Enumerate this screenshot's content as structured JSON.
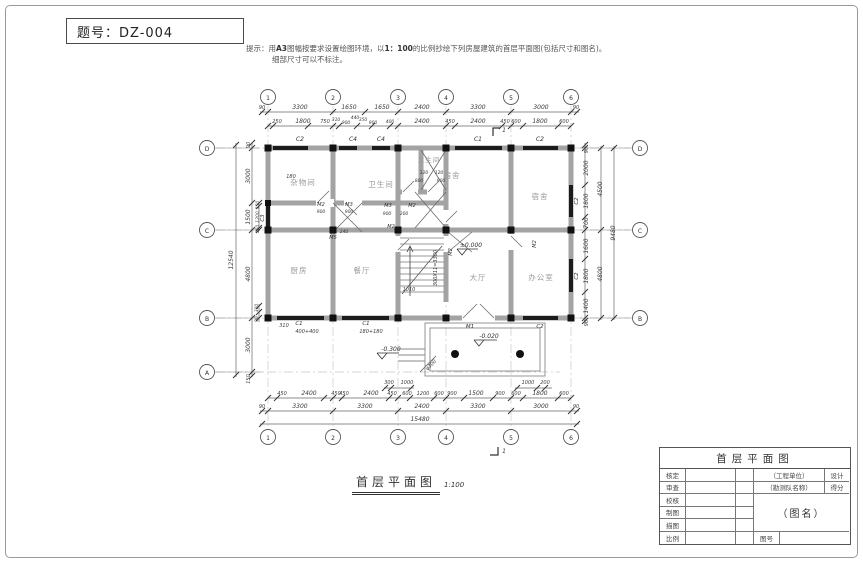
{
  "header": {
    "exam_label": "题号：DZ-004"
  },
  "hint": {
    "prefix": "提示：用",
    "bold1": "A3",
    "mid1": "图幅按要求设置绘图环境，以",
    "bold2": "1：100",
    "rest": "的比例抄绘下列房屋建筑的首层平面图(包括尺寸和图名)。",
    "line2": "细部尺寸可以不标注。"
  },
  "caption": {
    "title": "首层平面图",
    "scale": "1:100"
  },
  "title_block": {
    "header": "首层平面图",
    "row_labels": [
      "核定",
      "审查",
      "校核",
      "制图",
      "描图",
      "比例"
    ],
    "org": "（工程单位）",
    "design": "设计",
    "team": "（勘测队名称）",
    "score": "得分",
    "name": "（图名）",
    "no_label": "图号"
  },
  "plan": {
    "scale_note": "1:100",
    "rooms": [
      "杂物间",
      "卫生间",
      "卫生间",
      "宿舍",
      "宿舍",
      "厨房",
      "餐厅",
      "大厅",
      "办公室"
    ],
    "labels": [
      {
        "t": "1",
        "x": 268,
        "y": 100,
        "c": "axis"
      },
      {
        "t": "2",
        "x": 333,
        "y": 100,
        "c": "axis"
      },
      {
        "t": "3",
        "x": 398,
        "y": 100,
        "c": "axis"
      },
      {
        "t": "4",
        "x": 446,
        "y": 100,
        "c": "axis"
      },
      {
        "t": "5",
        "x": 511,
        "y": 100,
        "c": "axis"
      },
      {
        "t": "6",
        "x": 571,
        "y": 100,
        "c": "axis"
      },
      {
        "t": "1",
        "x": 268,
        "y": 440,
        "c": "axis"
      },
      {
        "t": "2",
        "x": 333,
        "y": 440,
        "c": "axis"
      },
      {
        "t": "3",
        "x": 398,
        "y": 440,
        "c": "axis"
      },
      {
        "t": "4",
        "x": 446,
        "y": 440,
        "c": "axis"
      },
      {
        "t": "5",
        "x": 511,
        "y": 440,
        "c": "axis"
      },
      {
        "t": "6",
        "x": 571,
        "y": 440,
        "c": "axis"
      },
      {
        "t": "D",
        "x": 207,
        "y": 151,
        "c": "axis"
      },
      {
        "t": "C",
        "x": 207,
        "y": 233,
        "c": "axis"
      },
      {
        "t": "B",
        "x": 207,
        "y": 321,
        "c": "axis"
      },
      {
        "t": "A",
        "x": 207,
        "y": 375,
        "c": "axis"
      },
      {
        "t": "D",
        "x": 640,
        "y": 151,
        "c": "axis"
      },
      {
        "t": "C",
        "x": 640,
        "y": 233,
        "c": "axis"
      },
      {
        "t": "B",
        "x": 640,
        "y": 321,
        "c": "axis"
      },
      {
        "t": "杂物间",
        "x": 303,
        "y": 185,
        "c": "room",
        "s": 7.5
      },
      {
        "t": "卫生间",
        "x": 381,
        "y": 187,
        "c": "room",
        "s": 7.5
      },
      {
        "t": "卫生间",
        "x": 429,
        "y": 162,
        "c": "room",
        "s": 6.5
      },
      {
        "t": "宿舍",
        "x": 452,
        "y": 178,
        "c": "room",
        "s": 7.5
      },
      {
        "t": "宿舍",
        "x": 540,
        "y": 199,
        "c": "room",
        "s": 7.5
      },
      {
        "t": "厨房",
        "x": 299,
        "y": 273,
        "c": "room",
        "s": 7.5
      },
      {
        "t": "餐厅",
        "x": 362,
        "y": 273,
        "c": "room",
        "s": 7.5
      },
      {
        "t": "大厅",
        "x": 478,
        "y": 280,
        "c": "room",
        "s": 7.5
      },
      {
        "t": "办公室",
        "x": 541,
        "y": 280,
        "c": "room",
        "s": 7.5
      },
      {
        "t": "90",
        "x": 262,
        "y": 109,
        "s": 5
      },
      {
        "t": "3300",
        "x": 300,
        "y": 109,
        "s": 6
      },
      {
        "t": "1650",
        "x": 349,
        "y": 109,
        "s": 6
      },
      {
        "t": "1650",
        "x": 382,
        "y": 109,
        "s": 6
      },
      {
        "t": "2400",
        "x": 422,
        "y": 109,
        "s": 6
      },
      {
        "t": "3300",
        "x": 478,
        "y": 109,
        "s": 6
      },
      {
        "t": "3000",
        "x": 541,
        "y": 109,
        "s": 6
      },
      {
        "t": "90",
        "x": 576,
        "y": 109,
        "s": 5
      },
      {
        "t": "250",
        "x": 277,
        "y": 123,
        "s": 5
      },
      {
        "t": "1800",
        "x": 303,
        "y": 123,
        "s": 6
      },
      {
        "t": "750",
        "x": 325,
        "y": 123,
        "s": 5
      },
      {
        "t": "310",
        "x": 336,
        "y": 121,
        "s": 4.5
      },
      {
        "t": "900",
        "x": 346,
        "y": 124,
        "s": 4.5
      },
      {
        "t": "440",
        "x": 355,
        "y": 119,
        "s": 4.5
      },
      {
        "t": "350",
        "x": 363,
        "y": 121,
        "s": 4.5
      },
      {
        "t": "900",
        "x": 373,
        "y": 124,
        "s": 4.5
      },
      {
        "t": "400",
        "x": 390,
        "y": 123,
        "s": 4.5
      },
      {
        "t": "2400",
        "x": 422,
        "y": 123,
        "s": 6
      },
      {
        "t": "450",
        "x": 450,
        "y": 123,
        "s": 5
      },
      {
        "t": "2400",
        "x": 478,
        "y": 123,
        "s": 6
      },
      {
        "t": "450",
        "x": 505,
        "y": 123,
        "s": 5
      },
      {
        "t": "600",
        "x": 516,
        "y": 123,
        "s": 5
      },
      {
        "t": "1800",
        "x": 540,
        "y": 123,
        "s": 6
      },
      {
        "t": "600",
        "x": 564,
        "y": 123,
        "s": 5
      },
      {
        "t": "C2",
        "x": 300,
        "y": 141,
        "c": "win",
        "s": 6
      },
      {
        "t": "C4",
        "x": 353,
        "y": 141,
        "c": "win",
        "s": 6
      },
      {
        "t": "C4",
        "x": 381,
        "y": 141,
        "c": "win",
        "s": 6
      },
      {
        "t": "C1",
        "x": 478,
        "y": 141,
        "c": "win",
        "s": 6
      },
      {
        "t": "C2",
        "x": 540,
        "y": 141,
        "c": "win",
        "s": 6
      },
      {
        "t": "1",
        "x": 504,
        "y": 132,
        "s": 6
      },
      {
        "t": "1",
        "x": 504,
        "y": 453,
        "s": 6
      },
      {
        "t": "12540",
        "x": 233,
        "y": 260,
        "r": -90,
        "s": 6
      },
      {
        "t": "90",
        "x": 250,
        "y": 145,
        "r": -90,
        "s": 5
      },
      {
        "t": "3000",
        "x": 250,
        "y": 176,
        "r": -90,
        "s": 6
      },
      {
        "t": "1500",
        "x": 250,
        "y": 217,
        "r": -90,
        "s": 6
      },
      {
        "t": "4800",
        "x": 250,
        "y": 274,
        "r": -90,
        "s": 6
      },
      {
        "t": "3000",
        "x": 250,
        "y": 345,
        "r": -90,
        "s": 6
      },
      {
        "t": "150",
        "x": 250,
        "y": 379,
        "r": -90,
        "s": 5
      },
      {
        "t": "150",
        "x": 259,
        "y": 205,
        "r": -90,
        "s": 4.5
      },
      {
        "t": "1200",
        "x": 259,
        "y": 217,
        "r": -90,
        "s": 4.5
      },
      {
        "t": "150",
        "x": 259,
        "y": 229,
        "r": -90,
        "s": 4.5
      },
      {
        "t": "C3",
        "x": 264,
        "y": 218,
        "r": -90,
        "c": "win",
        "s": 5.5
      },
      {
        "t": "310",
        "x": 258,
        "y": 308,
        "r": -90,
        "s": 4.5
      },
      {
        "t": "90",
        "x": 258,
        "y": 319,
        "r": -90,
        "s": 4.5
      },
      {
        "t": "180",
        "x": 291,
        "y": 178,
        "s": 5
      },
      {
        "t": "90",
        "x": 588,
        "y": 150,
        "r": -90,
        "s": 5
      },
      {
        "t": "2000",
        "x": 588,
        "y": 168,
        "r": -90,
        "s": 6
      },
      {
        "t": "1800",
        "x": 588,
        "y": 201,
        "r": -90,
        "s": 6
      },
      {
        "t": "700",
        "x": 588,
        "y": 223,
        "r": -90,
        "s": 6
      },
      {
        "t": "1600",
        "x": 588,
        "y": 246,
        "r": -90,
        "s": 6
      },
      {
        "t": "1800",
        "x": 588,
        "y": 276,
        "r": -90,
        "s": 6
      },
      {
        "t": "1400",
        "x": 588,
        "y": 306,
        "r": -90,
        "s": 6
      },
      {
        "t": "90",
        "x": 588,
        "y": 323,
        "r": -90,
        "s": 5
      },
      {
        "t": "4500",
        "x": 602,
        "y": 189,
        "r": -90,
        "s": 6
      },
      {
        "t": "4800",
        "x": 602,
        "y": 274,
        "r": -90,
        "s": 6
      },
      {
        "t": "9480",
        "x": 615,
        "y": 233,
        "r": -90,
        "s": 6
      },
      {
        "t": "C2",
        "x": 578,
        "y": 201,
        "r": -90,
        "c": "win",
        "s": 5.5
      },
      {
        "t": "C2",
        "x": 578,
        "y": 276,
        "r": -90,
        "c": "win",
        "s": 5.5
      },
      {
        "t": "450",
        "x": 282,
        "y": 395,
        "s": 5
      },
      {
        "t": "2400",
        "x": 309,
        "y": 395,
        "s": 6
      },
      {
        "t": "450",
        "x": 336,
        "y": 395,
        "s": 5
      },
      {
        "t": "450",
        "x": 344,
        "y": 395,
        "s": 5
      },
      {
        "t": "2400",
        "x": 371,
        "y": 395,
        "s": 6
      },
      {
        "t": "450",
        "x": 392,
        "y": 395,
        "s": 5
      },
      {
        "t": "600",
        "x": 407,
        "y": 395,
        "s": 5
      },
      {
        "t": "1200",
        "x": 423,
        "y": 395,
        "s": 5
      },
      {
        "t": "600",
        "x": 439,
        "y": 395,
        "s": 5
      },
      {
        "t": "900",
        "x": 452,
        "y": 395,
        "s": 5
      },
      {
        "t": "1500",
        "x": 476,
        "y": 395,
        "s": 6
      },
      {
        "t": "900",
        "x": 500,
        "y": 395,
        "s": 5
      },
      {
        "t": "600",
        "x": 516,
        "y": 395,
        "s": 5
      },
      {
        "t": "1800",
        "x": 540,
        "y": 395,
        "s": 6
      },
      {
        "t": "600",
        "x": 564,
        "y": 395,
        "s": 5
      },
      {
        "t": "300",
        "x": 389,
        "y": 384,
        "s": 5
      },
      {
        "t": "1000",
        "x": 407,
        "y": 384,
        "s": 5
      },
      {
        "t": "1000",
        "x": 528,
        "y": 384,
        "s": 5
      },
      {
        "t": "200",
        "x": 545,
        "y": 384,
        "s": 5
      },
      {
        "t": "90",
        "x": 262,
        "y": 408,
        "s": 5
      },
      {
        "t": "3300",
        "x": 300,
        "y": 408,
        "s": 6
      },
      {
        "t": "3300",
        "x": 365,
        "y": 408,
        "s": 6
      },
      {
        "t": "2400",
        "x": 422,
        "y": 408,
        "s": 6
      },
      {
        "t": "3300",
        "x": 478,
        "y": 408,
        "s": 6
      },
      {
        "t": "3000",
        "x": 541,
        "y": 408,
        "s": 6
      },
      {
        "t": "90",
        "x": 576,
        "y": 408,
        "s": 5
      },
      {
        "t": "15480",
        "x": 420,
        "y": 421,
        "s": 6
      },
      {
        "t": "310",
        "x": 284,
        "y": 327,
        "s": 5
      },
      {
        "t": "C1",
        "x": 299,
        "y": 325,
        "c": "win",
        "s": 5.5
      },
      {
        "t": "400+400",
        "x": 307,
        "y": 333,
        "s": 5
      },
      {
        "t": "C1",
        "x": 366,
        "y": 325,
        "c": "win",
        "s": 5.5
      },
      {
        "t": "180+180",
        "x": 371,
        "y": 333,
        "s": 5
      },
      {
        "t": "M1",
        "x": 470,
        "y": 328,
        "c": "win",
        "s": 5.5
      },
      {
        "t": "C2",
        "x": 540,
        "y": 328,
        "c": "win",
        "s": 5.5
      },
      {
        "t": "±0.000",
        "x": 471,
        "y": 247,
        "c": "lvl",
        "s": 6
      },
      {
        "t": "-0.020",
        "x": 489,
        "y": 338,
        "c": "lvl",
        "s": 6
      },
      {
        "t": "-0.300",
        "x": 391,
        "y": 351,
        "c": "lvl",
        "s": 6
      },
      {
        "t": "φ300",
        "x": 432,
        "y": 366,
        "r": -45,
        "s": 5
      },
      {
        "t": "300X11=3300",
        "x": 437,
        "y": 268,
        "r": -90,
        "s": 5
      },
      {
        "t": "1010",
        "x": 409,
        "y": 291,
        "s": 5
      },
      {
        "t": "M2",
        "x": 321,
        "y": 206,
        "c": "win",
        "s": 5
      },
      {
        "t": "M3",
        "x": 349,
        "y": 206,
        "c": "win",
        "s": 5
      },
      {
        "t": "900",
        "x": 321,
        "y": 213,
        "s": 4.5
      },
      {
        "t": "900",
        "x": 349,
        "y": 213,
        "s": 4.5
      },
      {
        "t": "M5",
        "x": 333,
        "y": 239,
        "c": "win",
        "s": 5
      },
      {
        "t": "240",
        "x": 344,
        "y": 233,
        "s": 4.5
      },
      {
        "t": "120",
        "x": 424,
        "y": 174,
        "s": 4.5
      },
      {
        "t": "120",
        "x": 439,
        "y": 174,
        "s": 4.5
      },
      {
        "t": "800",
        "x": 419,
        "y": 182,
        "s": 4.5
      },
      {
        "t": "900",
        "x": 441,
        "y": 182,
        "s": 4.5
      },
      {
        "t": "M3",
        "x": 388,
        "y": 207,
        "c": "win",
        "s": 5
      },
      {
        "t": "M2",
        "x": 412,
        "y": 207,
        "c": "win",
        "s": 5
      },
      {
        "t": "900",
        "x": 387,
        "y": 215,
        "s": 4.5
      },
      {
        "t": "200",
        "x": 404,
        "y": 215,
        "s": 4.5
      },
      {
        "t": "M2",
        "x": 391,
        "y": 228,
        "c": "win",
        "s": 5
      },
      {
        "t": "M2",
        "x": 536,
        "y": 244,
        "r": -90,
        "c": "win",
        "s": 5
      },
      {
        "t": "M2",
        "x": 452,
        "y": 252,
        "r": -90,
        "c": "win",
        "s": 5
      }
    ]
  }
}
